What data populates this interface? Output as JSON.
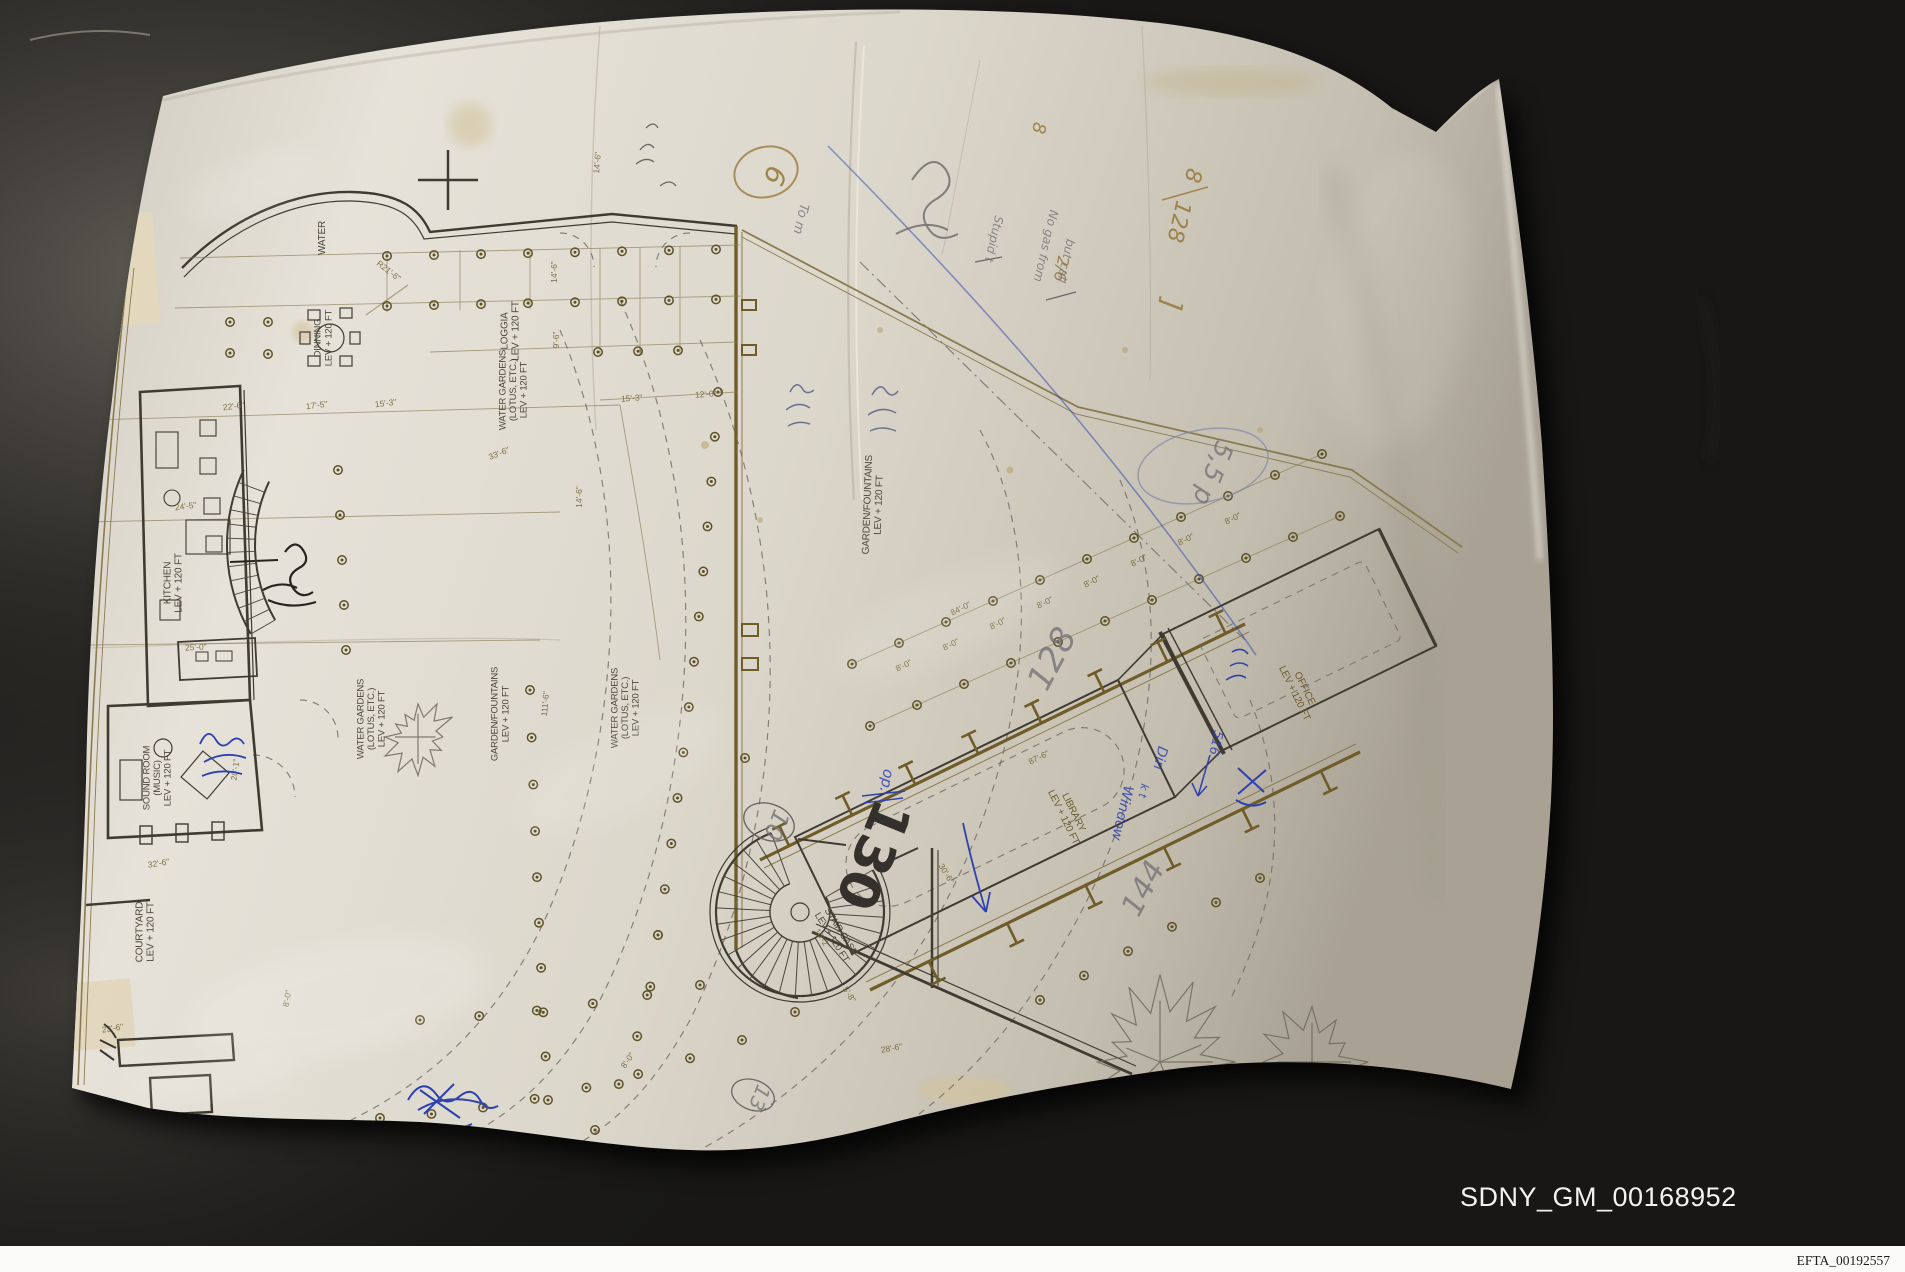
{
  "photo": {
    "bates_label": "SDNY_GM_00168952",
    "footer_label": "EFTA_00192557"
  },
  "colors": {
    "wall_background": "#2f2d2a",
    "paper": "#ddd8cd",
    "plan_olive_ink": "#6f5c28",
    "plan_dark_ink": "#3f3b32",
    "blue_pen": "#2e41b0",
    "pencil": "#767378",
    "bates_text": "#f2f2f0"
  },
  "plan": {
    "rooms": [
      {
        "lines": [
          "WATER"
        ],
        "x": 325,
        "y": 238,
        "rot": -90,
        "size": 10,
        "c": "dark"
      },
      {
        "lines": [
          "DINNING",
          "LEV + 120 FT"
        ],
        "x": 326,
        "y": 338,
        "rot": -90,
        "size": 9.5,
        "c": "dark"
      },
      {
        "lines": [
          "LOGGIA",
          "LEV + 120 FT"
        ],
        "x": 513,
        "y": 331,
        "rot": -90,
        "size": 10,
        "c": "dark"
      },
      {
        "lines": [
          "WATER GARDENS",
          "(LOTUS, ETC.)",
          "LEV + 120 FT"
        ],
        "x": 516,
        "y": 390,
        "rot": -90,
        "size": 9.5,
        "c": "dark"
      },
      {
        "lines": [
          "KITCHEN",
          "LEV + 120 FT"
        ],
        "x": 176,
        "y": 583,
        "rot": -90,
        "size": 10,
        "c": "dark"
      },
      {
        "lines": [
          "SOUND ROOM",
          "(MUSIC)",
          "LEV + 120 FT"
        ],
        "x": 160,
        "y": 778,
        "rot": -90,
        "size": 9.5,
        "c": "dark"
      },
      {
        "lines": [
          "COURTYARD",
          "LEV + 120 FT"
        ],
        "x": 148,
        "y": 932,
        "rot": -90,
        "size": 10,
        "c": "dark"
      },
      {
        "lines": [
          "WATER GARDENS",
          "(LOTUS, ETC.)",
          "LEV + 120 FT"
        ],
        "x": 374,
        "y": 719,
        "rot": -90,
        "size": 9.5,
        "c": "dark"
      },
      {
        "lines": [
          "GARDEN/FOUNTAINS",
          "LEV + 120 FT"
        ],
        "x": 503,
        "y": 714,
        "rot": -90,
        "size": 9.5,
        "c": "dark"
      },
      {
        "lines": [
          "WATER GARDENS",
          "(LOTUS, ETC.)",
          "LEV + 120 FT"
        ],
        "x": 628,
        "y": 708,
        "rot": -90,
        "size": 9.5,
        "c": "dark"
      },
      {
        "lines": [
          "GARDEN/FOUNTAINS",
          "LEV + 120 FT"
        ],
        "x": 876,
        "y": 505,
        "rot": -88,
        "size": 10,
        "c": "dark"
      },
      {
        "lines": [
          "LIBRARY",
          "LEV + 120 FT"
        ],
        "x": 1066,
        "y": 816,
        "rot": 64,
        "size": 10,
        "c": "sepia"
      },
      {
        "lines": [
          "OFFICE",
          "LEV + 120 FT"
        ],
        "x": 1297,
        "y": 692,
        "rot": 64,
        "size": 10,
        "c": "sepia"
      },
      {
        "lines": [
          "STAIR CASE",
          "LEV + 120 FT"
        ],
        "x": 834,
        "y": 936,
        "rot": 58,
        "size": 9.5,
        "c": "dark"
      }
    ],
    "dimensions": [
      {
        "t": "14'-6\"",
        "x": 557,
        "y": 272,
        "r": -90
      },
      {
        "t": "9'-6\"",
        "x": 559,
        "y": 340,
        "r": -90
      },
      {
        "t": "14'-6\"",
        "x": 582,
        "y": 497,
        "r": -90
      },
      {
        "t": "14'-6\"",
        "x": 600,
        "y": 163,
        "r": -85
      },
      {
        "t": "15'-3\"",
        "x": 632,
        "y": 401,
        "r": -4
      },
      {
        "t": "12'-0\"",
        "x": 706,
        "y": 397,
        "r": -4
      },
      {
        "t": "33'-6\"",
        "x": 500,
        "y": 456,
        "r": -22
      },
      {
        "t": "22'-6\"",
        "x": 234,
        "y": 409,
        "r": -7
      },
      {
        "t": "17'-5\"",
        "x": 317,
        "y": 408,
        "r": -7
      },
      {
        "t": "15'-3\"",
        "x": 386,
        "y": 406,
        "r": -7
      },
      {
        "t": "24'-5\"",
        "x": 186,
        "y": 509,
        "r": -7
      },
      {
        "t": "25'-0\"",
        "x": 196,
        "y": 650,
        "r": -3
      },
      {
        "t": "20'-1\"",
        "x": 238,
        "y": 770,
        "r": -83
      },
      {
        "t": "32'-6\"",
        "x": 159,
        "y": 866,
        "r": -9
      },
      {
        "t": "23'-6\"",
        "x": 113,
        "y": 1031,
        "r": -9
      },
      {
        "t": "8'-0\"",
        "x": 290,
        "y": 999,
        "r": -80
      },
      {
        "t": "8'-0\"",
        "x": 630,
        "y": 1062,
        "r": -55
      },
      {
        "t": "R21'-6\"",
        "x": 387,
        "y": 273,
        "r": 38
      },
      {
        "t": "111'-6\"",
        "x": 548,
        "y": 704,
        "r": -85
      },
      {
        "t": "84'-0\"",
        "x": 962,
        "y": 611,
        "r": -26
      },
      {
        "t": "87'-6\"",
        "x": 1040,
        "y": 760,
        "r": -26
      },
      {
        "t": "30'-6\"",
        "x": 944,
        "y": 875,
        "r": 58
      },
      {
        "t": "28'-6\"",
        "x": 892,
        "y": 1051,
        "r": -10
      },
      {
        "t": "10'-2\"",
        "x": 820,
        "y": 940,
        "r": 58
      },
      {
        "t": "5'-8\"",
        "x": 847,
        "y": 996,
        "r": 58
      },
      {
        "t": "8'-0\"",
        "x": 905,
        "y": 668,
        "r": -26
      },
      {
        "t": "8'-0\"",
        "x": 952,
        "y": 647,
        "r": -26
      },
      {
        "t": "8'-0\"",
        "x": 999,
        "y": 626,
        "r": -26
      },
      {
        "t": "8'-0\"",
        "x": 1046,
        "y": 605,
        "r": -26
      },
      {
        "t": "8'-0\"",
        "x": 1093,
        "y": 584,
        "r": -26
      },
      {
        "t": "8'-0\"",
        "x": 1140,
        "y": 563,
        "r": -26
      },
      {
        "t": "8'-0\"",
        "x": 1187,
        "y": 542,
        "r": -26
      },
      {
        "t": "8'-0\"",
        "x": 1234,
        "y": 521,
        "r": -26
      }
    ],
    "annotations": [
      {
        "t": "130",
        "x": 856,
        "y": 848,
        "r": 112,
        "s": 54,
        "c": "marker"
      },
      {
        "t": "128",
        "x": 1062,
        "y": 664,
        "r": -62,
        "s": 34,
        "c": "pencil"
      },
      {
        "t": "144",
        "x": 1152,
        "y": 893,
        "r": -62,
        "s": 30,
        "c": "pencil"
      },
      {
        "t": "10",
        "x": 769,
        "y": 822,
        "r": 112,
        "s": 24,
        "c": "pencil"
      },
      {
        "t": "13",
        "x": 753,
        "y": 1095,
        "r": 112,
        "s": 20,
        "c": "pencil"
      },
      {
        "t": "5,5 p",
        "x": 1205,
        "y": 470,
        "r": 112,
        "s": 26,
        "c": "pencil"
      },
      {
        "t": "6",
        "x": 766,
        "y": 172,
        "r": 112,
        "s": 28,
        "c": "sepia"
      },
      {
        "t": "8",
        "x": 1033,
        "y": 127,
        "r": 100,
        "s": 18,
        "c": "sepia"
      },
      {
        "t": "8",
        "x": 1186,
        "y": 174,
        "r": 103,
        "s": 22,
        "c": "sepia"
      },
      {
        "t": "128",
        "x": 1172,
        "y": 220,
        "r": 103,
        "s": 22,
        "c": "sepia"
      },
      {
        "t": "2/6",
        "x": 1056,
        "y": 268,
        "r": 100,
        "s": 16,
        "c": "sepia"
      },
      {
        "t": "]",
        "x": 1162,
        "y": 303,
        "r": 100,
        "s": 28,
        "c": "sepia"
      },
      {
        "t": "Window",
        "x": 1118,
        "y": 812,
        "r": 103,
        "s": 14,
        "c": "blue"
      },
      {
        "t": "k t",
        "x": 1140,
        "y": 790,
        "r": 103,
        "s": 11,
        "c": "blue"
      },
      {
        "t": "Din",
        "x": 1156,
        "y": 757,
        "r": 103,
        "s": 14,
        "c": "blue"
      },
      {
        "t": "516",
        "x": 1212,
        "y": 742,
        "r": 103,
        "s": 13,
        "c": "blue"
      },
      {
        "t": "op.",
        "x": 882,
        "y": 780,
        "r": 100,
        "s": 15,
        "c": "blue"
      },
      {
        "t": "No gas from",
        "x": 1042,
        "y": 245,
        "r": 103,
        "s": 12,
        "c": "pencil"
      },
      {
        "t": "but call",
        "x": 1062,
        "y": 260,
        "r": 103,
        "s": 12,
        "c": "pencil"
      },
      {
        "t": "Stupid t",
        "x": 990,
        "y": 238,
        "r": 103,
        "s": 12,
        "c": "pencil"
      },
      {
        "t": "To m",
        "x": 797,
        "y": 218,
        "r": 103,
        "s": 13,
        "c": "pencil"
      }
    ]
  }
}
